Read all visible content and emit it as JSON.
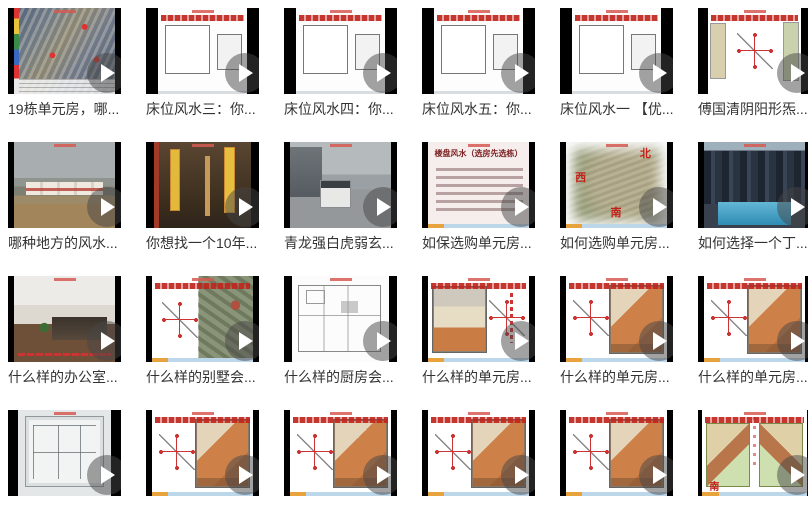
{
  "page": {
    "background": "#ffffff",
    "title_color": "#333333",
    "accent_red": "#c0251d",
    "play_overlay": "rgba(70,70,70,0.5)"
  },
  "videos": [
    {
      "title": "19栋单元房，哪...",
      "kind": "aerial"
    },
    {
      "title": "床位风水三：你...",
      "kind": "plan-bw"
    },
    {
      "title": "床位风水四：你...",
      "kind": "plan-bw"
    },
    {
      "title": "床位风水五：你...",
      "kind": "plan-bw"
    },
    {
      "title": "床位风水一 【优...",
      "kind": "plan-bw"
    },
    {
      "title": "傅国清阴阳形炁...",
      "kind": "compass"
    },
    {
      "title": "哪种地方的风水...",
      "kind": "photo-flood"
    },
    {
      "title": "你想找一个10年...",
      "kind": "photo-shop"
    },
    {
      "title": "青龙强白虎弱玄...",
      "kind": "photo-street"
    },
    {
      "title": "如保选购单元房...",
      "kind": "slide-text",
      "overlay_title": "楼盘风水（选房先选栋）"
    },
    {
      "title": "如何选购单元房...",
      "kind": "aerial-compass",
      "labels": {
        "north": "北",
        "west": "西",
        "south": "南"
      }
    },
    {
      "title": "如何选择一个丁...",
      "kind": "photo-model"
    },
    {
      "title": "什么样的办公室...",
      "kind": "photo-office"
    },
    {
      "title": "什么样的别墅会...",
      "kind": "satellite"
    },
    {
      "title": "什么样的厨房会...",
      "kind": "plan-sketch"
    },
    {
      "title": "什么样的单元房...",
      "kind": "plan-color-right"
    },
    {
      "title": "什么样的单元房...",
      "kind": "plan-color-left"
    },
    {
      "title": "什么样的单元房...",
      "kind": "plan-color-left"
    },
    {
      "title": "",
      "kind": "blueprint"
    },
    {
      "title": "",
      "kind": "plan-color-left"
    },
    {
      "title": "",
      "kind": "plan-color-left"
    },
    {
      "title": "",
      "kind": "plan-color-left"
    },
    {
      "title": "",
      "kind": "plan-color-left"
    },
    {
      "title": "",
      "kind": "plan-duplex",
      "south_label": "南"
    }
  ]
}
